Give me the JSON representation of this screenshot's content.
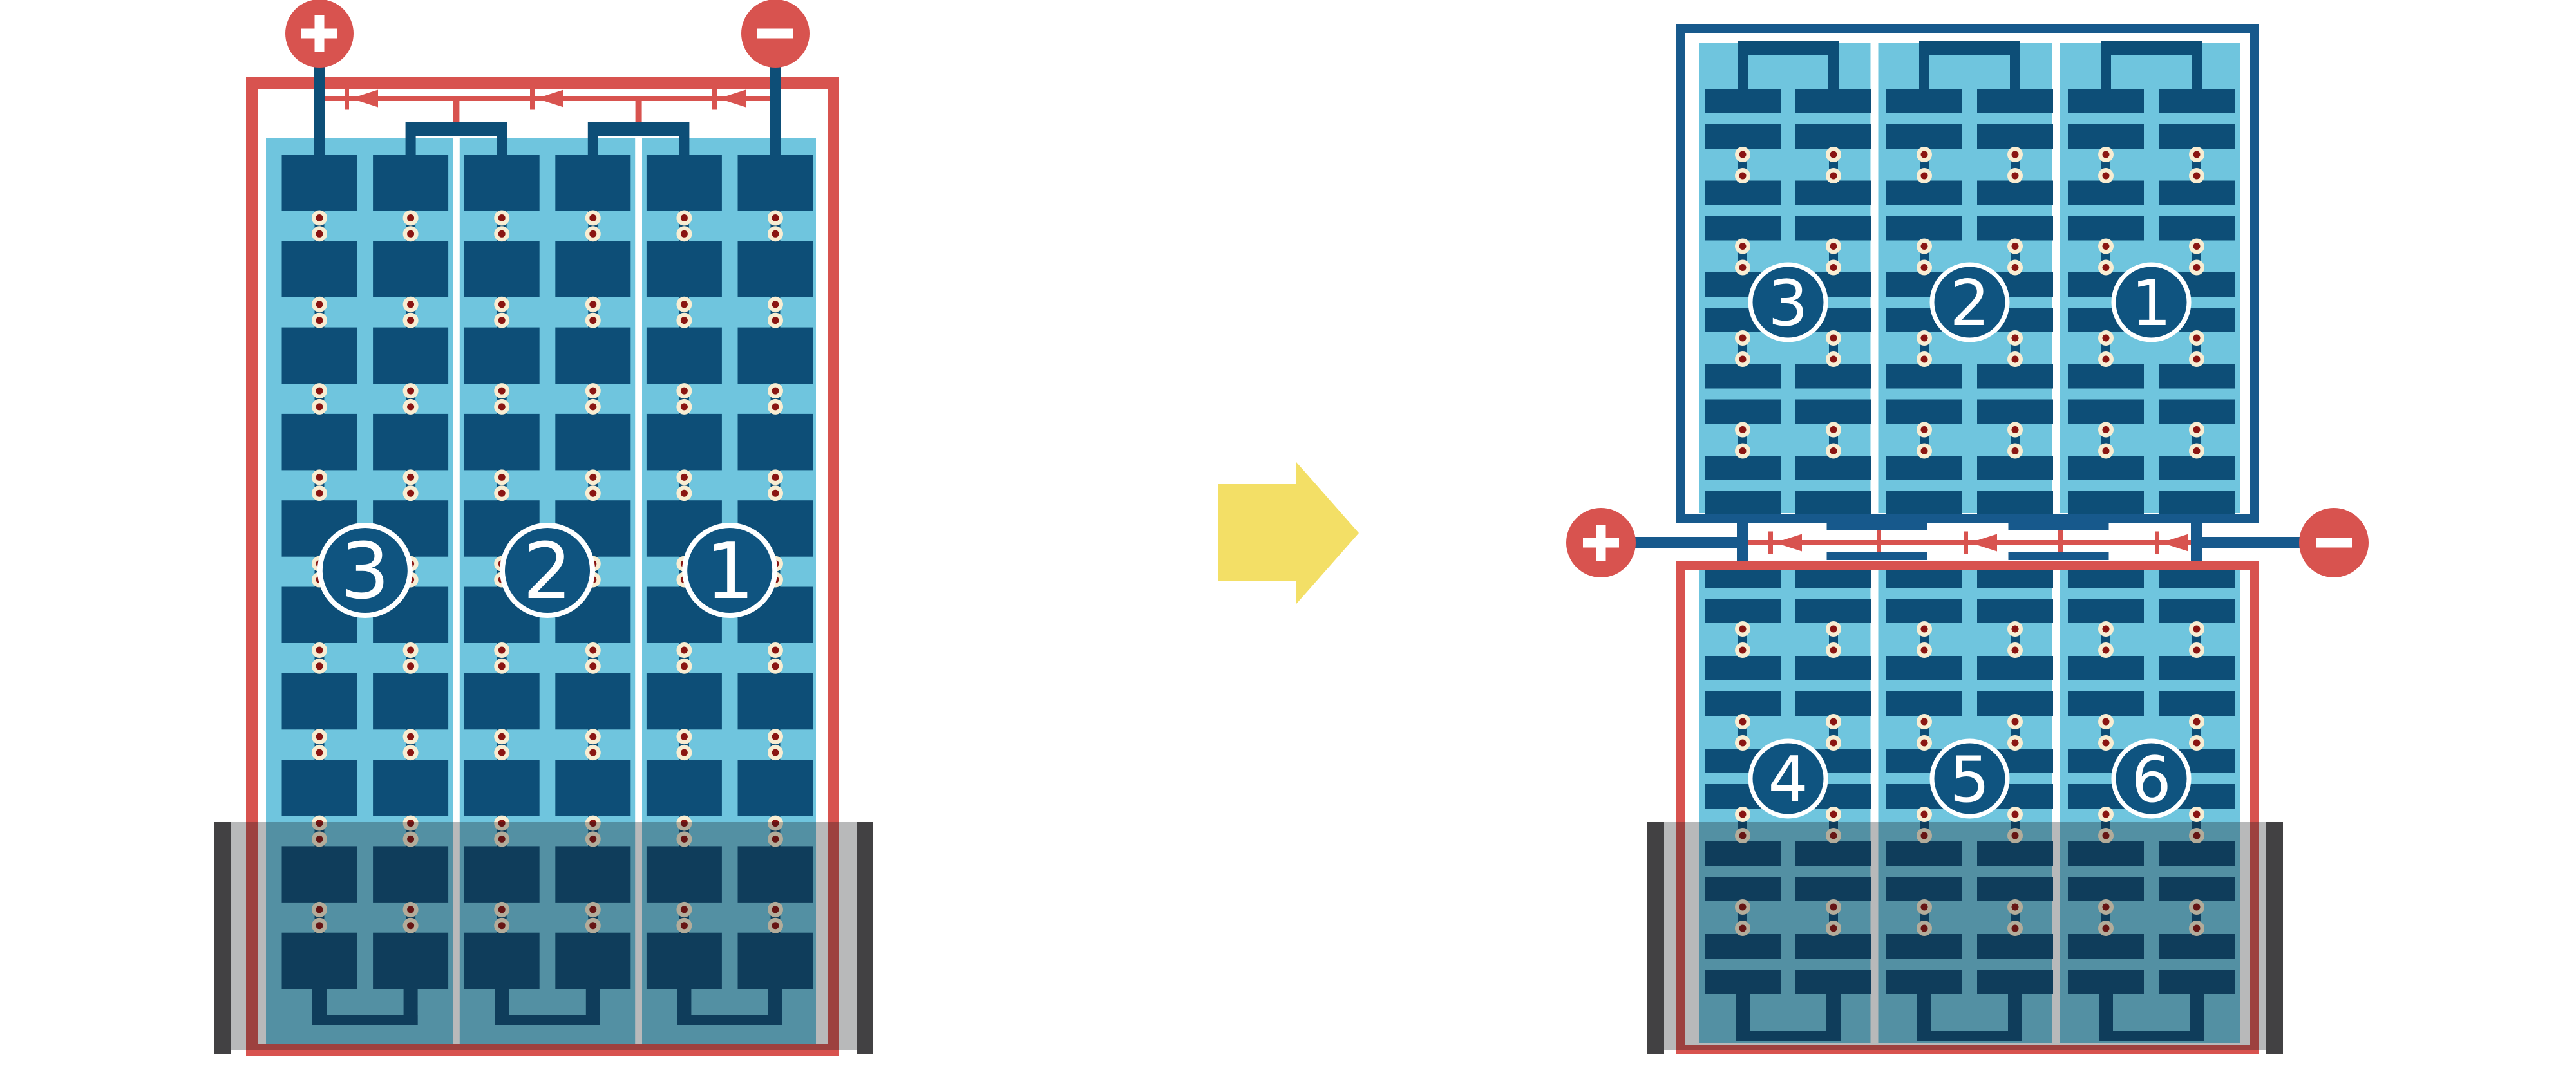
{
  "figure": {
    "kind": "solar-panel-string-reconfiguration-diagram",
    "left_panel": {
      "string_numbers": [
        "3",
        "2",
        "1"
      ],
      "bypass_diode_count": 3,
      "state": "single panel, lower rows flooded"
    },
    "right_top_panel": {
      "string_numbers": [
        "3",
        "2",
        "1"
      ]
    },
    "right_bottom_panel": {
      "string_numbers": [
        "4",
        "5",
        "6"
      ],
      "bypass_diode_count": 3,
      "state": "lower rows flooded"
    },
    "transform_arrow": {
      "direction": "right"
    }
  },
  "labels": {
    "positive": "+",
    "negative": "−"
  },
  "colors": {
    "red": "#D8534F",
    "cell_navy": "#0D4E77",
    "frame_navy": "#17598C",
    "badge_navy": "#0F5480",
    "light_blue": "#6FC5DE",
    "white": "#FFFFFF",
    "dot_cream": "#F8EDD2",
    "dot_center": "#8A1512",
    "flood_overlay": "rgba(20,22,26,0.30)",
    "flood_cap": "#424143",
    "arrow_yellow": "#F3DF66"
  }
}
